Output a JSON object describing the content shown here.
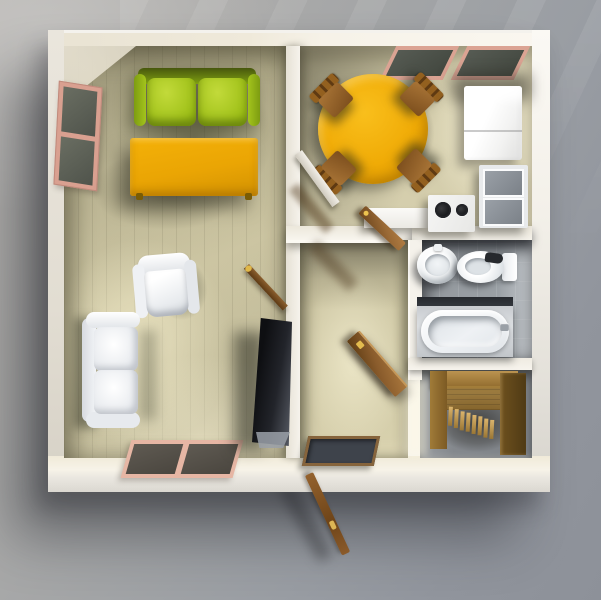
{
  "scene": {
    "type": "3d-floorplan-top-down-render",
    "description": "Top-down 3D render of a small apartment floating over a gray backdrop with cast shadow",
    "rooms": [
      {
        "id": "living-room",
        "furniture": [
          "green-sofa",
          "orange-coffee-table",
          "white-armchair",
          "white-loveseat",
          "tv",
          "left-window",
          "front-window"
        ]
      },
      {
        "id": "kitchen-dining",
        "furniture": [
          "round-dining-table",
          "dining-chair-top-left",
          "dining-chair-top-right",
          "dining-chair-bottom-left",
          "dining-chair-bottom-right",
          "refrigerator",
          "glass-cabinet",
          "kitchen-counter",
          "stove",
          "back-window",
          "white-door"
        ]
      },
      {
        "id": "hallway",
        "furniture": [
          "doormat",
          "kitchen-door",
          "staircase-door",
          "living-room-door",
          "front-door"
        ]
      },
      {
        "id": "bathroom",
        "furniture": [
          "sink",
          "toilet",
          "bathtub"
        ]
      },
      {
        "id": "staircase-room",
        "furniture": [
          "wooden-staircase"
        ]
      }
    ],
    "palette": {
      "background_top": "#b7b5b2",
      "background_bottom": "#8d9199",
      "wall_white": "#f3efe7",
      "wall_cream": "#ece6d6",
      "wood_floor": "#cdc6a2",
      "sofa_green": "#a3c41c",
      "sofa_green_dark": "#47570d",
      "table_orange": "#eca805",
      "dining_table_orange": "#f0ab06",
      "chair_wood": "#8a5a2a",
      "door_wood": "#8a5c2c",
      "window_frame_pink": "#dca595",
      "window_glass": "#585c54",
      "bathroom_tile": "#9aa0a5",
      "fixture_white": "#f3f5f7",
      "tv_black": "#23252a",
      "knob_gold": "#dcb554",
      "stairs_wood": "#9a7634"
    }
  }
}
